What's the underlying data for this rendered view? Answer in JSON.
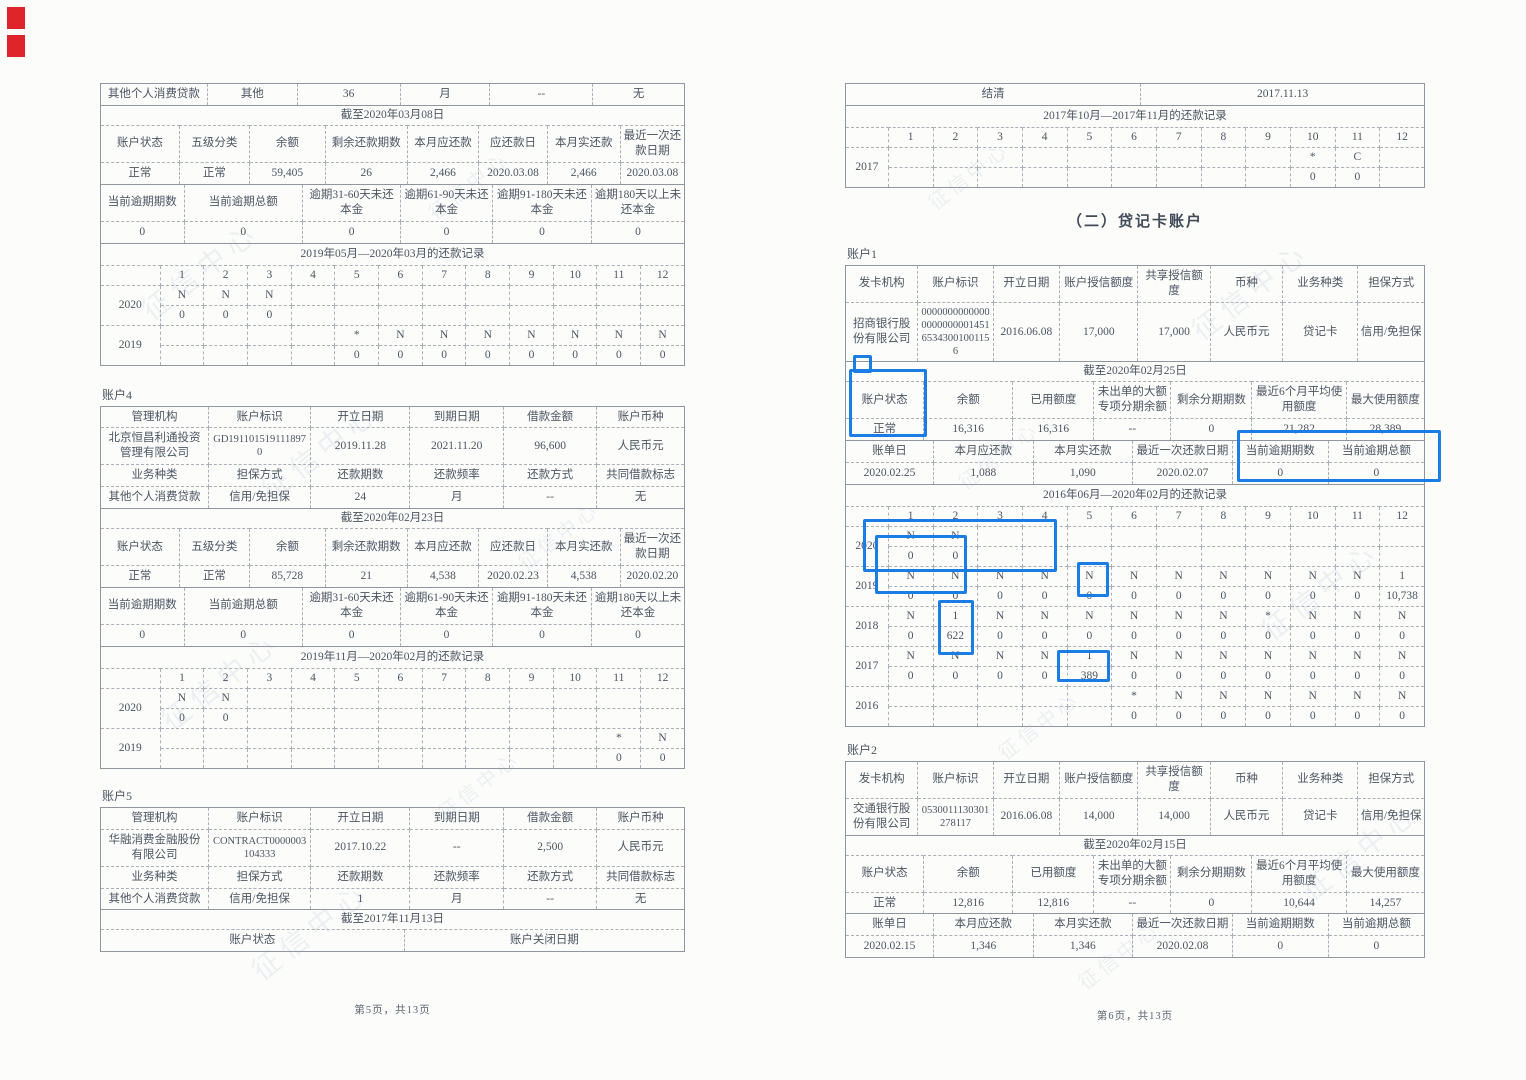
{
  "watermark": "征信中心",
  "section_title": "（二）贷记卡账户",
  "labels": {
    "account4": "账户4",
    "account5": "账户5",
    "account1": "账户1",
    "account2": "账户2"
  },
  "footer": {
    "left": "第5页，共13页",
    "right": "第6页，共13页"
  },
  "colors": {
    "highlight_blue": "#1a7ce5",
    "redaction_red": "#e0242b"
  },
  "tables": {
    "l1_top": {
      "rows": [
        [
          "其他个人消费贷款",
          "其他",
          "36",
          "月",
          "--",
          "无"
        ]
      ]
    },
    "l1_status": {
      "rows": [
        [
          {
            "t": "截至2020年03月08日",
            "cs": 8,
            "cls": "merged"
          }
        ],
        [
          "账户状态",
          "五级分类",
          "余额",
          "剩余还款期数",
          "本月应还款",
          "应还款日",
          "本月实还款",
          "最近一次还款日期"
        ],
        [
          "正常",
          "正常",
          "59,405",
          "26",
          "2,466",
          "2020.03.08",
          "2,466",
          "2020.03.08"
        ]
      ]
    },
    "l1_overdue": {
      "rows": [
        [
          "当前逾期期数",
          "当前逾期总额",
          "逾期31-60天未还本金",
          "逾期61-90天未还本金",
          "逾期91-180天未还本金",
          "逾期180天以上未还本金"
        ],
        [
          "0",
          "0",
          "0",
          "0",
          "0",
          "0"
        ]
      ]
    },
    "l1_rec": {
      "rows": [
        [
          {
            "t": "2019年05月—2020年03月的还款记录",
            "cs": 13,
            "cls": "merged"
          }
        ],
        [
          "",
          "1",
          "2",
          "3",
          "4",
          "5",
          "6",
          "7",
          "8",
          "9",
          "10",
          "11",
          "12"
        ],
        [
          {
            "t": "2020",
            "rs": 2
          },
          "N",
          "N",
          "N",
          "",
          "",
          "",
          "",
          "",
          "",
          "",
          "",
          ""
        ],
        [
          "0",
          "0",
          "0",
          "",
          "",
          "",
          "",
          "",
          "",
          "",
          "",
          ""
        ],
        [
          {
            "t": "2019",
            "rs": 2
          },
          "",
          "",
          "",
          "",
          "*",
          "N",
          "N",
          "N",
          "N",
          "N",
          "N",
          "N"
        ],
        [
          "",
          "",
          "",
          "",
          "0",
          "0",
          "0",
          "0",
          "0",
          "0",
          "0",
          "0"
        ]
      ]
    },
    "l4_top": {
      "rows": [
        [
          "管理机构",
          "账户标识",
          "开立日期",
          "到期日期",
          "借款金额",
          "账户币种"
        ],
        [
          "北京恒昌利通投资管理有限公司",
          {
            "t": "GD1911015191118970",
            "cls": "brk"
          },
          "2019.11.28",
          "2021.11.20",
          "96,600",
          "人民币元"
        ],
        [
          "业务种类",
          "担保方式",
          "还款期数",
          "还款频率",
          "还款方式",
          "共同借款标志"
        ],
        [
          "其他个人消费贷款",
          "信用/免担保",
          "24",
          "月",
          "--",
          "无"
        ]
      ]
    },
    "l4_status": {
      "rows": [
        [
          {
            "t": "截至2020年02月23日",
            "cs": 8,
            "cls": "merged"
          }
        ],
        [
          "账户状态",
          "五级分类",
          "余额",
          "剩余还款期数",
          "本月应还款",
          "应还款日",
          "本月实还款",
          "最近一次还款日期"
        ],
        [
          "正常",
          "正常",
          "85,728",
          "21",
          "4,538",
          "2020.02.23",
          "4,538",
          "2020.02.20"
        ]
      ]
    },
    "l4_overdue": {
      "rows": [
        [
          "当前逾期期数",
          "当前逾期总额",
          "逾期31-60天未还本金",
          "逾期61-90天未还本金",
          "逾期91-180天未还本金",
          "逾期180天以上未还本金"
        ],
        [
          "0",
          "0",
          "0",
          "0",
          "0",
          "0"
        ]
      ]
    },
    "l4_rec": {
      "rows": [
        [
          {
            "t": "2019年11月—2020年02月的还款记录",
            "cs": 13,
            "cls": "merged"
          }
        ],
        [
          "",
          "1",
          "2",
          "3",
          "4",
          "5",
          "6",
          "7",
          "8",
          "9",
          "10",
          "11",
          "12"
        ],
        [
          {
            "t": "2020",
            "rs": 2
          },
          "N",
          "N",
          "",
          "",
          "",
          "",
          "",
          "",
          "",
          "",
          "",
          ""
        ],
        [
          "0",
          "0",
          "",
          "",
          "",
          "",
          "",
          "",
          "",
          "",
          "",
          ""
        ],
        [
          {
            "t": "2019",
            "rs": 2
          },
          "",
          "",
          "",
          "",
          "",
          "",
          "",
          "",
          "",
          "",
          "*",
          "N"
        ],
        [
          "",
          "",
          "",
          "",
          "",
          "",
          "",
          "",
          "",
          "",
          "0",
          "0"
        ]
      ]
    },
    "l5_top": {
      "rows": [
        [
          "管理机构",
          "账户标识",
          "开立日期",
          "到期日期",
          "借款金额",
          "账户币种"
        ],
        [
          "华融消费金融股份有限公司",
          {
            "t": "CONTRACT0000003104333",
            "cls": "brk"
          },
          "2017.10.22",
          "--",
          "2,500",
          "人民币元"
        ],
        [
          "业务种类",
          "担保方式",
          "还款期数",
          "还款频率",
          "还款方式",
          "共同借款标志"
        ],
        [
          "其他个人消费贷款",
          "信用/免担保",
          "1",
          "月",
          "--",
          "无"
        ]
      ]
    },
    "l5_close": {
      "rows": [
        [
          {
            "t": "截至2017年11月13日",
            "cs": 2,
            "cls": "merged"
          }
        ],
        [
          "账户状态",
          "账户关闭日期"
        ]
      ]
    },
    "r0_top": {
      "rows": [
        [
          "结清",
          "2017.11.13"
        ]
      ]
    },
    "r0_rec": {
      "rows": [
        [
          {
            "t": "2017年10月—2017年11月的还款记录",
            "cs": 13,
            "cls": "merged"
          }
        ],
        [
          "",
          "1",
          "2",
          "3",
          "4",
          "5",
          "6",
          "7",
          "8",
          "9",
          "10",
          "11",
          "12"
        ],
        [
          {
            "t": "2017",
            "rs": 2
          },
          "",
          "",
          "",
          "",
          "",
          "",
          "",
          "",
          "",
          "*",
          "C",
          ""
        ],
        [
          "",
          "",
          "",
          "",
          "",
          "",
          "",
          "",
          "",
          "0",
          "0",
          ""
        ]
      ]
    },
    "r1_top": {
      "rows": [
        [
          "发卡机构",
          "账户标识",
          "开立日期",
          "账户授信额度",
          "共享授信额度",
          "币种",
          "业务种类",
          "担保方式"
        ],
        [
          "招商银行股份有限公司",
          {
            "t": "0000000000000000000000145165343001001156",
            "cls": "brk"
          },
          "2016.06.08",
          "17,000",
          "17,000",
          "人民币元",
          "贷记卡",
          "信用/免担保"
        ]
      ]
    },
    "r1_status": {
      "rows": [
        [
          {
            "t": "截至2020年02月25日",
            "cs": 7,
            "cls": "merged"
          }
        ],
        [
          "账户状态",
          "余额",
          "已用额度",
          "未出单的大额专项分期余额",
          "剩余分期期数",
          "最近6个月平均使用额度",
          "最大使用额度"
        ],
        [
          "正常",
          "16,316",
          "16,316",
          "--",
          "0",
          "21,282",
          "28,389"
        ]
      ]
    },
    "r1_bill": {
      "rows": [
        [
          "账单日",
          "本月应还款",
          "本月实还款",
          "最近一次还款日期",
          "当前逾期期数",
          "当前逾期总额"
        ],
        [
          "2020.02.25",
          "1,088",
          "1,090",
          "2020.02.07",
          "0",
          "0"
        ]
      ]
    },
    "r1_rec": {
      "rows": [
        [
          {
            "t": "2016年06月—2020年02月的还款记录",
            "cs": 13,
            "cls": "merged"
          }
        ],
        [
          "",
          "1",
          "2",
          "3",
          "4",
          "5",
          "6",
          "7",
          "8",
          "9",
          "10",
          "11",
          "12"
        ],
        [
          {
            "t": "2020",
            "rs": 2
          },
          "N",
          "N",
          "",
          "",
          "",
          "",
          "",
          "",
          "",
          "",
          "",
          ""
        ],
        [
          "0",
          "0",
          "",
          "",
          "",
          "",
          "",
          "",
          "",
          "",
          "",
          ""
        ],
        [
          {
            "t": "2019",
            "rs": 2
          },
          "N",
          "N",
          "N",
          "N",
          "N",
          "N",
          "N",
          "N",
          "N",
          "N",
          "N",
          "1"
        ],
        [
          "0",
          "0",
          "0",
          "0",
          "0",
          "0",
          "0",
          "0",
          "0",
          "0",
          "0",
          "10,738"
        ],
        [
          {
            "t": "2018",
            "rs": 2
          },
          "N",
          "1",
          "N",
          "N",
          "N",
          "N",
          "N",
          "N",
          "*",
          "N",
          "N",
          "N"
        ],
        [
          "0",
          "622",
          "0",
          "0",
          "0",
          "0",
          "0",
          "0",
          "0",
          "0",
          "0",
          "0"
        ],
        [
          {
            "t": "2017",
            "rs": 2
          },
          "N",
          "N",
          "N",
          "N",
          "1",
          "N",
          "N",
          "N",
          "N",
          "N",
          "N",
          "N"
        ],
        [
          "0",
          "0",
          "0",
          "0",
          "389",
          "0",
          "0",
          "0",
          "0",
          "0",
          "0",
          "0"
        ],
        [
          {
            "t": "2016",
            "rs": 2
          },
          "",
          "",
          "",
          "",
          "",
          "*",
          "N",
          "N",
          "N",
          "N",
          "N",
          "N"
        ],
        [
          "",
          "",
          "",
          "",
          "",
          "0",
          "0",
          "0",
          "0",
          "0",
          "0",
          "0"
        ]
      ]
    },
    "r2_top": {
      "rows": [
        [
          "发卡机构",
          "账户标识",
          "开立日期",
          "账户授信额度",
          "共享授信额度",
          "币种",
          "业务种类",
          "担保方式"
        ],
        [
          "交通银行股份有限公司",
          {
            "t": "0530011130301278117",
            "cls": "brk"
          },
          "2016.06.08",
          "14,000",
          "14,000",
          "人民币元",
          "贷记卡",
          "信用/免担保"
        ]
      ]
    },
    "r2_status": {
      "rows": [
        [
          {
            "t": "截至2020年02月15日",
            "cs": 7,
            "cls": "merged"
          }
        ],
        [
          "账户状态",
          "余额",
          "已用额度",
          "未出单的大额专项分期余额",
          "剩余分期期数",
          "最近6个月平均使用额度",
          "最大使用额度"
        ],
        [
          "正常",
          "12,816",
          "12,816",
          "--",
          "0",
          "10,644",
          "14,257"
        ]
      ]
    },
    "r2_bill": {
      "rows": [
        [
          "账单日",
          "本月应还款",
          "本月实还款",
          "最近一次还款日期",
          "当前逾期期数",
          "当前逾期总额"
        ],
        [
          "2020.02.15",
          "1,346",
          "1,346",
          "2020.02.08",
          "0",
          "0"
        ]
      ]
    }
  }
}
